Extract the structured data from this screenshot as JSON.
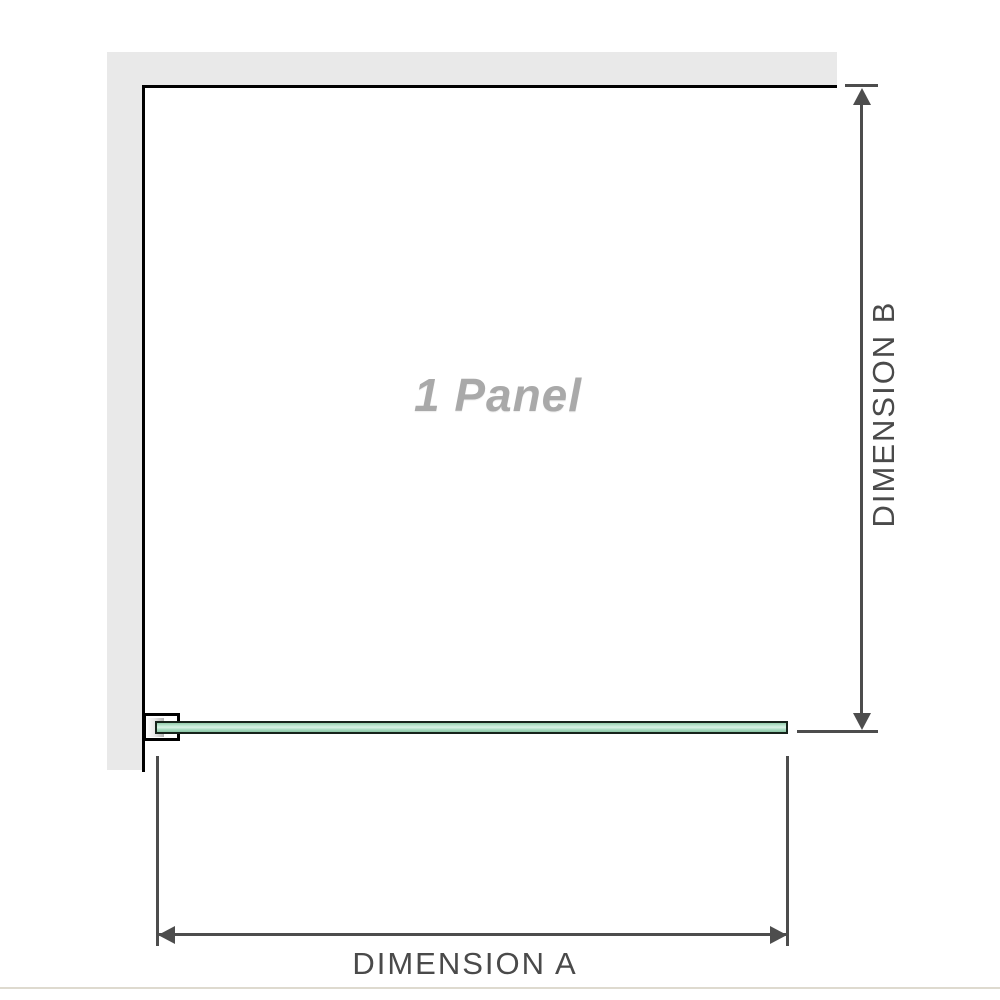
{
  "diagram": {
    "title": "shower screen single panel dimension diagram",
    "panel_label": "1 Panel",
    "dimension_a": {
      "label": "DIMENSION A",
      "orientation": "horizontal"
    },
    "dimension_b": {
      "label": "DIMENSION B",
      "orientation": "vertical"
    },
    "icons": {
      "arrow_up": "arrow-up-icon",
      "arrow_down": "arrow-down-icon",
      "arrow_left": "arrow-left-icon",
      "arrow_right": "arrow-right-icon"
    },
    "colors": {
      "wall_fill": "#e9e9e9",
      "enclosure_outline": "#000000",
      "dimension_line": "#4d4d4d",
      "dimension_label_text": "#4a4a4a",
      "panel_label_text": "#a9a9a9",
      "glass_fill": "#a9dcc2",
      "glass_border": "#16231b",
      "bracket_fill": "#ffffff",
      "footer_rule": "#dedacf"
    }
  }
}
